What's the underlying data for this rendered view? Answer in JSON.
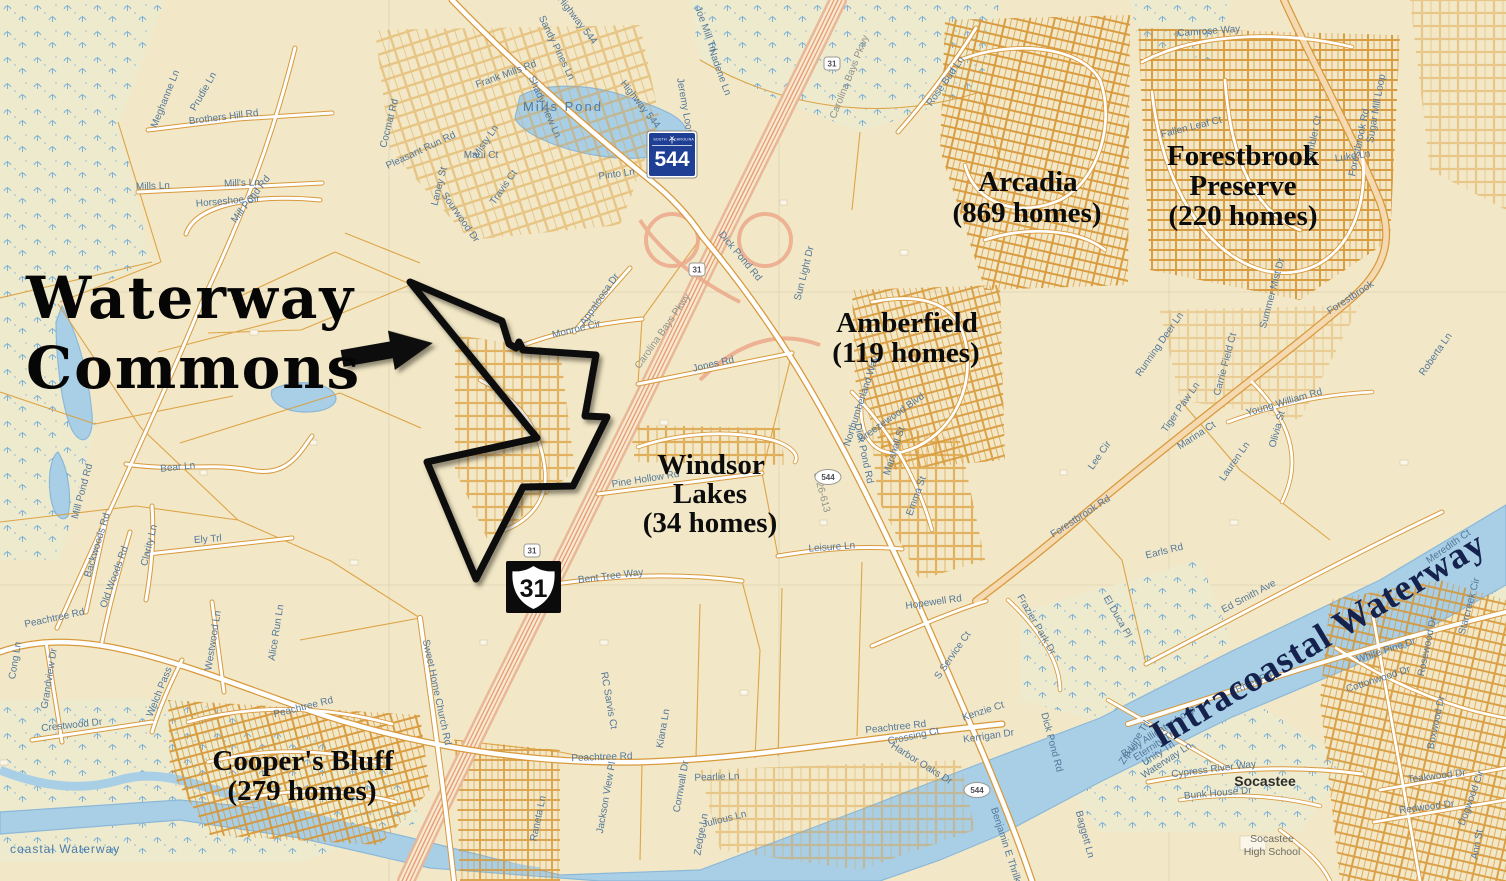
{
  "annotation": {
    "title_line1": "Waterway",
    "title_line2": "Commons"
  },
  "subdivisions": {
    "arcadia": {
      "name": "Arcadia",
      "homes": "(869 homes)"
    },
    "forestbrook_preserve": {
      "line1": "Forestbrook",
      "line2": "Preserve",
      "homes": "(220 homes)"
    },
    "amberfield": {
      "name": "Amberfield",
      "homes": "(119 homes)"
    },
    "windsor_lakes": {
      "line1": "Windsor",
      "line2": "Lakes",
      "homes": "(34 homes)"
    },
    "coopers_bluff": {
      "name": "Cooper's Bluff",
      "homes": "(279 homes)"
    }
  },
  "water_labels": {
    "mills_pond": "Mills Pond",
    "intracoastal": "Intracoastal Waterway",
    "intracoastal_edge": "coastal Waterway"
  },
  "places": {
    "socastee": "Socastee",
    "school_line1": "Socastee",
    "school_line2": "High School"
  },
  "shields": {
    "sc544": {
      "state_left": "SOUTH",
      "state_right": "CAROLINA",
      "number": "544"
    },
    "us31": {
      "number": "31"
    },
    "small_31": "31",
    "small_544": "544"
  },
  "colors": {
    "background_cream": "#F2E8C7",
    "parcel_line_orange": "#DB9C38",
    "water_blue": "#A9CFE6",
    "highway_salmon": "#E9B494",
    "shield_blue": "#1E3F94",
    "label_blue": "#54779A",
    "boundary_black": "#0A0A0A",
    "intracoastal_navy": "#15224D"
  },
  "roads": [
    "Meghanne Ln",
    "Prudie Ln",
    "Brothers Hill Rd",
    "Mills Ln",
    "Mill's Ln",
    "Horseshoe Cir",
    "Mill Pond Rd",
    "Mill Pond Rd",
    "Bear Ln",
    "Backwoods Rd",
    "Old Woods Rd",
    "Clarity Ln",
    "Ely Trl",
    "Westwood Ln",
    "Alice Run Ln",
    "Cong Ln",
    "Grandview Dr",
    "Crestwood Dr",
    "Welch Pass",
    "Peachtree Rd",
    "Peachtree Rd",
    "Peachtree Rd",
    "Peachtree Rd",
    "Sweet Home Church Rd",
    "Raneta Ln",
    "RC Sarvis Ct",
    "Jackson View Pl",
    "Cornwall Dr",
    "Kiana Ln",
    "Pearlie Ln",
    "Julious Ln",
    "Zedge Ln",
    "Bent Tree Way",
    "Pine Hollow Rd",
    "Leisure Ln",
    "Jones Rd",
    "Monroe Cir",
    "Appaloosa Dr",
    "Carolina Bays Pkwy",
    "Carolina Bays Pkwy",
    "Sun Light Dr",
    "Rose Bud Ln",
    "Dick Pond Rd",
    "Dick Pond Rd",
    "Dick Pond Rd",
    "Highway 544",
    "Jeremy Loop",
    "Nadene Ln",
    "Pinto Ln",
    "Sandy Pines Ln",
    "Frank Mills Rd",
    "Shady View Ln",
    "Misty Ln",
    "Travis Ct",
    "Cocmat Rd",
    "Pleasant Run Rd",
    "Maui Ct",
    "Laney St",
    "Sourwood Dr",
    "Camrose Way",
    "Fallen Leaf Ct",
    "Rambler Ct",
    "Luke Ln",
    "Sugar Mill Loop",
    "Summer Mist Dr",
    "Forestbrook Rd",
    "Forestbrook",
    "Forestbrook Rd",
    "Lee Cir",
    "Earls Rd",
    "Ed Smith Ave",
    "River Rd",
    "White Pine Dr",
    "Cottonwood Dr",
    "Rosewood Dr",
    "Meredith Ct",
    "Starcreek Cir",
    "Boxwood Dr",
    "Teakwood Dr",
    "Redwood Dr",
    "Dogwood Cir",
    "Ann St",
    "Cypress River Way",
    "Bunk House Dr",
    "Baby Alligator Loop",
    "Zip Line Trl",
    "Eternity Trl",
    "Unity Trl",
    "Waterway Ln",
    "Roberta Ln",
    "Young William Rd",
    "Olivia St",
    "Marina Ct",
    "Lauren Ln",
    "Tiger Paw Ln",
    "Running Deer Ln",
    "Carrie Field Ct",
    "Hopewell Rd",
    "S Service Ct",
    "Kenzie Ct",
    "Kerrigan Dr",
    "Harbor Oaks Dr",
    "Crossing Ct",
    "Frazier Park Dr",
    "El Duca Pl",
    "Benjamin E Thrilkill",
    "Baggett Ln",
    "Breezewood Blvd",
    "Northumberland Way",
    "Marshall St",
    "Emma St",
    "S-26-613",
    "Joe Mill Trl",
    "Highway 544"
  ]
}
